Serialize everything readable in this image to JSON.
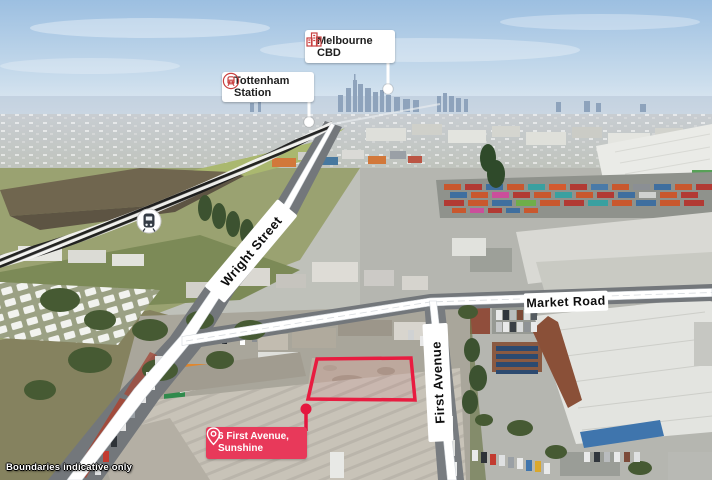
{
  "image": {
    "type": "aerial-property-marketing-photo",
    "disclaimer": "Boundaries indicative only"
  },
  "callouts": {
    "melbourne_cbd": {
      "label": "Melbourne CBD",
      "icon": "city-buildings-icon",
      "marker": "white-dot"
    },
    "tottenham_station": {
      "label": "Tottenham Station",
      "icon": "train-icon",
      "marker": "white-dot"
    }
  },
  "road_labels": {
    "wright_street": "Wright Street",
    "market_road": "Market Road",
    "first_avenue": "First Avenue"
  },
  "railway": {
    "marker_icon": "train-on-track-icon"
  },
  "property": {
    "address_line1": "6 First Avenue,",
    "address_line2": "Sunshine",
    "pin_icon": "location-pin-icon",
    "boundary_color": "#e81c40",
    "label_color": "#e8395a"
  },
  "colors": {
    "callout_background": "#ffffff",
    "road_band": "#ffffff",
    "text_dark": "#1e1e1e",
    "text_light": "#ffffff"
  }
}
